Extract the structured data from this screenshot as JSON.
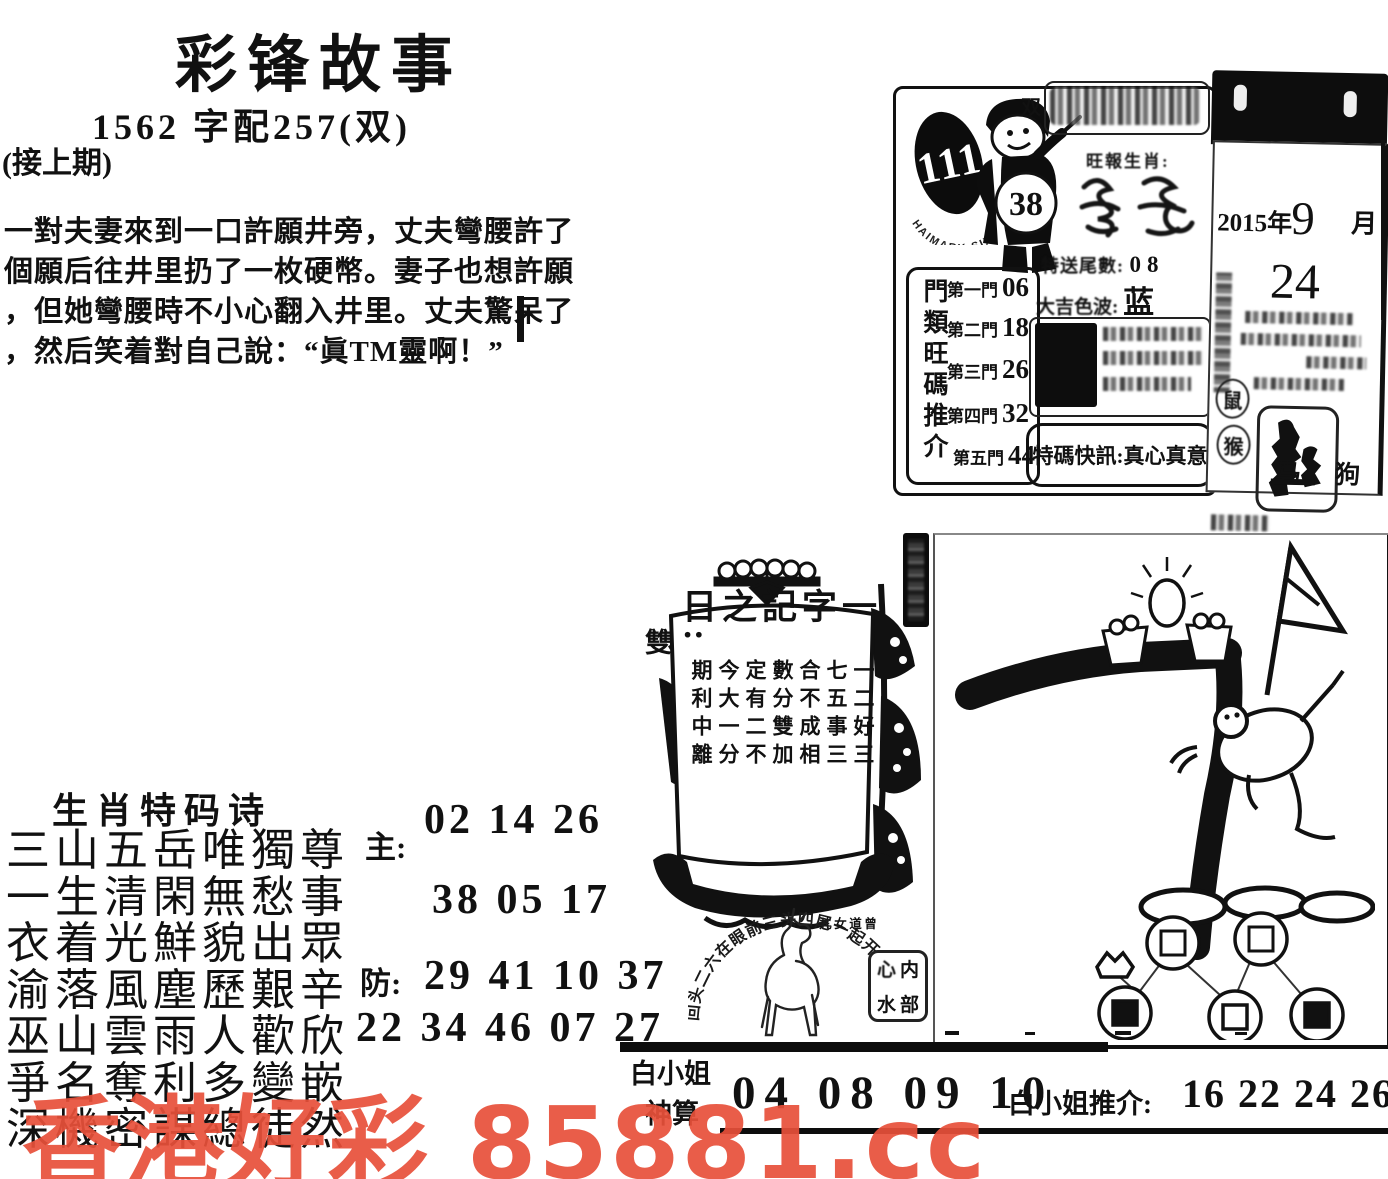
{
  "header": {
    "title": "彩锋故事",
    "subtitle": "1562 字配257(双)",
    "continued": "(接上期)"
  },
  "story": {
    "lines": [
      "一對夫妻來到一口許願井旁，丈夫彎腰許了",
      "個願后往井里扔了一枚硬幣。妻子也想許願",
      "，但她彎腰時不小心翻入井里。丈夫驚呆了",
      "，然后笑着對自己說：“眞TM靈啊！”"
    ]
  },
  "promo": {
    "issue": "111",
    "arc_text": "HAIMARK SIX",
    "ball": "38",
    "bubble_char": "双",
    "zodiac_label": "旺報生肖:",
    "tail_label": "特送尾數:",
    "tail_value": "08",
    "gates_label": "門類旺碼推介",
    "gates": [
      {
        "name": "第一門",
        "value": "06"
      },
      {
        "name": "第二門",
        "value": "18"
      },
      {
        "name": "第三門",
        "value": "26"
      },
      {
        "name": "第四門",
        "value": "32"
      },
      {
        "name": "第五門",
        "value": "44"
      }
    ],
    "color_label": "大吉色波:",
    "color_value": "蓝 红",
    "flash_label": "特碼快訊:",
    "flash_value": "真心真意"
  },
  "calendar": {
    "year": "2015年",
    "month": "9",
    "month_unit": "月",
    "day": "24",
    "zodiac_top": "鼠",
    "zodiac_bottom": "猴",
    "animals": "马 狗"
  },
  "ship": {
    "sail_title": "一字記之日:",
    "sail_answer": "雙",
    "sail_lines": [
      "一七合數定今期",
      "二五不分有大利",
      "好事成雙二一中",
      "三三相加不分離"
    ],
    "sail_sign": "曾道女儿"
  },
  "horse": {
    "arc_text": "回头二六在眼前三头四尾一起开"
  },
  "inner_stamp": {
    "text": "内部心水",
    "top_right": "内",
    "top_left": "心",
    "bottom_right": "部",
    "bottom_left": "水"
  },
  "poem": {
    "heading": "生肖特码诗",
    "lines": [
      "三山五岳唯獨尊",
      "一生清閑無愁事",
      "衣着光鮮貌出眾",
      "渝落風塵歷艱辛",
      "巫山雲雨人歡欣",
      "爭名奪利多變嵌",
      "深機密謀總徒然"
    ]
  },
  "numbers": {
    "main_label": "主:",
    "main_line1": "02 14 26",
    "main_line2": "38 05 17",
    "guard_label": "防:",
    "guard_line1": "29 41 10 37",
    "guard_line2": "22 34 46 07 27"
  },
  "bottom": {
    "left_top": "白小姐",
    "left_bottom": "神算",
    "numbers": "04 08 09  10",
    "tui_label": "白小姐推介:",
    "tui_numbers": "16 22 24 26 28 36"
  },
  "watermark": {
    "text": "香港好彩 85881.cc",
    "color": "#e8503a"
  }
}
